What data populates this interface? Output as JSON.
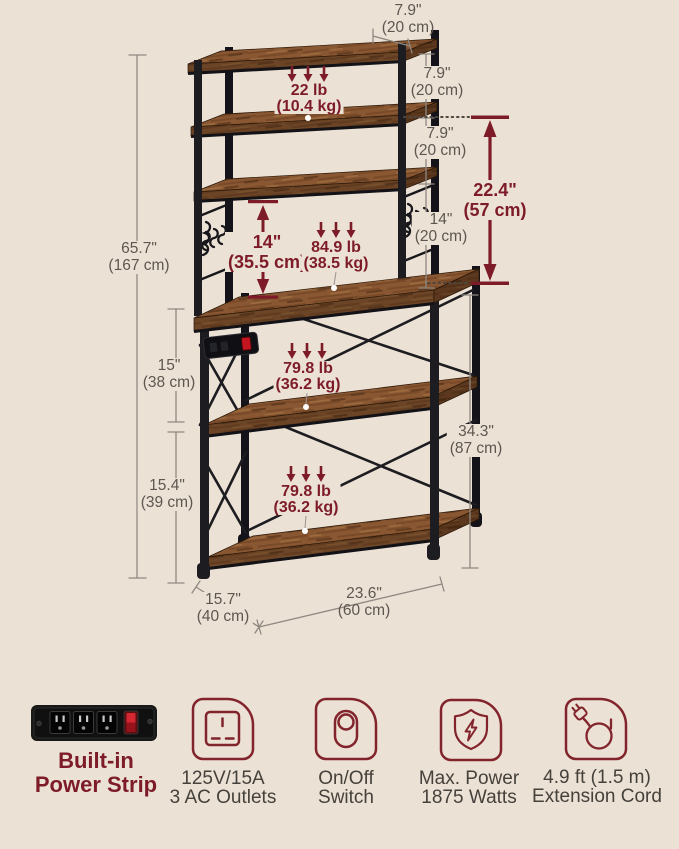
{
  "colors": {
    "background": "#ece1d5",
    "accent_red": "#7d1c28",
    "icon_red": "#82242b",
    "dim_text": "#5d5750",
    "feature_text": "#45413b",
    "line": "#8f8881",
    "wood_brown": "#8a5733",
    "metal_black": "#1d1c20"
  },
  "measurements": {
    "top_depth": {
      "value": "7.9\"",
      "metric": "(20 cm)"
    },
    "gap_top": {
      "value": "7.9\"",
      "metric": "(20 cm)"
    },
    "gap_middle": {
      "value": "7.9\"",
      "metric": "(20 cm)"
    },
    "gap_bottom": {
      "value": "14\"",
      "metric": "(20 cm)"
    },
    "hutch_height": {
      "value": "22.4\"",
      "metric": "(57 cm)"
    },
    "hutch_clearance": {
      "value": "14\"",
      "metric": "(35.5 cm)"
    },
    "total_height": {
      "value": "65.7\"",
      "metric": "(167 cm)"
    },
    "table_clearance": {
      "value": "15\"",
      "metric": "(38 cm)"
    },
    "shelf_clearance": {
      "value": "15.4\"",
      "metric": "(39 cm)"
    },
    "base_height": {
      "value": "34.3\"",
      "metric": "(87 cm)"
    },
    "depth": {
      "value": "15.7\"",
      "metric": "(40 cm)"
    },
    "width": {
      "value": "23.6\"",
      "metric": "(60 cm)"
    }
  },
  "capacities": {
    "hutch_shelf": {
      "value": "22 lb",
      "metric": "(10.4 kg)"
    },
    "tabletop": {
      "value": "84.9 lb",
      "metric": "(38.5 kg)"
    },
    "middle_shelf": {
      "value": "79.8 lb",
      "metric": "(36.2 kg)"
    },
    "bottom_shelf": {
      "value": "79.8 lb",
      "metric": "(36.2 kg)"
    }
  },
  "features": {
    "power_strip": {
      "icon": "power-strip-photo",
      "line1": "Built-in",
      "line2": "Power Strip"
    },
    "outlets": {
      "icon": "socket-icon",
      "line1": "125V/15A",
      "line2": "3 AC Outlets"
    },
    "switch": {
      "icon": "toggle-switch-icon",
      "line1": "On/Off",
      "line2": "Switch"
    },
    "max_power": {
      "icon": "shield-lightning-icon",
      "line1": "Max. Power",
      "line2": "1875 Watts"
    },
    "cord": {
      "icon": "coiled-cord-plug-icon",
      "line1": "4.9 ft (1.5 m)",
      "line2": "Extension Cord"
    }
  }
}
